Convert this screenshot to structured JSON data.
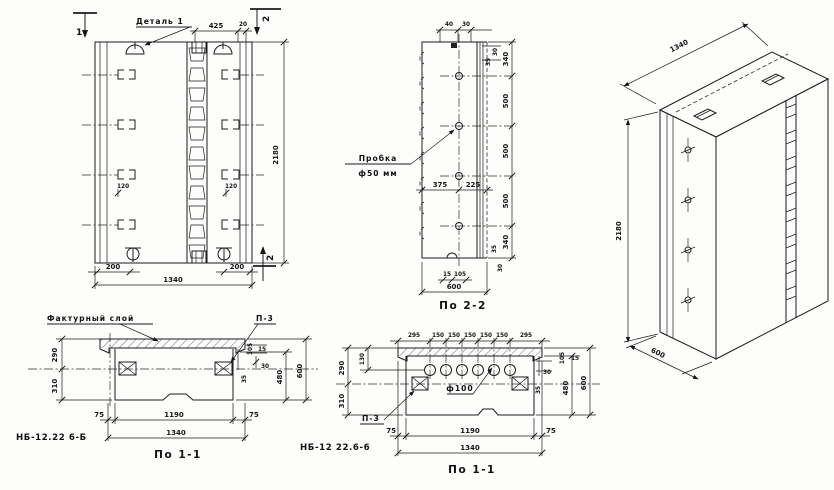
{
  "front_view": {
    "detail_label": "Деталь 1",
    "dims": {
      "top_425": "425",
      "top_20": "20",
      "bottom_200_left": "200",
      "bottom_200_right": "200",
      "bottom_1340": "1340",
      "height_2180": "2180",
      "bracket_120_left": "120",
      "bracket_120_right": "120"
    },
    "section_marks": {
      "top_left": "1",
      "top_right": "2",
      "bottom_right": "2"
    }
  },
  "section_2_2": {
    "title": "По 2-2",
    "plug_label_1": "Пробка",
    "plug_label_2": "ф50 мм",
    "dims": {
      "top_40": "40",
      "top_30": "30",
      "side_30_top": "30",
      "side_35_top": "35",
      "chain": [
        "340",
        "500",
        "500",
        "500",
        "340"
      ],
      "mid_375": "375",
      "mid_225": "225",
      "side_35_bottom": "35",
      "side_30_bottom": "30",
      "bottom_15": "15",
      "bottom_105": "105",
      "bottom_600": "600"
    }
  },
  "iso_view": {
    "dims": {
      "width_1340": "1340",
      "height_2180": "2180",
      "depth_600": "600"
    }
  },
  "section_1_1_left": {
    "title": "По 1-1",
    "facing_layer_label": "Фактурный слой",
    "p3_label": "П-3",
    "part_mark": "НБ-12.22 6-Б",
    "dims": {
      "left_290": "290",
      "left_310": "310",
      "right_105": "105",
      "right_15": "15",
      "right_30": "30",
      "right_35": "35",
      "right_480": "480",
      "right_600": "600",
      "bottom_75_left": "75",
      "bottom_1190": "1190",
      "bottom_75_right": "75",
      "bottom_1340": "1340"
    }
  },
  "section_1_1_right": {
    "title": "По 1-1",
    "p3_label": "П-3",
    "hole_label": "ф100",
    "part_mark": "НБ-12 22.6-6",
    "dims": {
      "top": [
        "295",
        "150",
        "150",
        "150",
        "150",
        "150",
        "295"
      ],
      "left_130": "130",
      "left_290": "290",
      "left_310": "310",
      "right_30": "30",
      "right_35": "35",
      "right_105": "105",
      "right_15": "15",
      "right_480": "480",
      "right_600": "600",
      "bottom_75_left": "75",
      "bottom_1190": "1190",
      "bottom_75_right": "75",
      "bottom_1340": "1340"
    }
  }
}
